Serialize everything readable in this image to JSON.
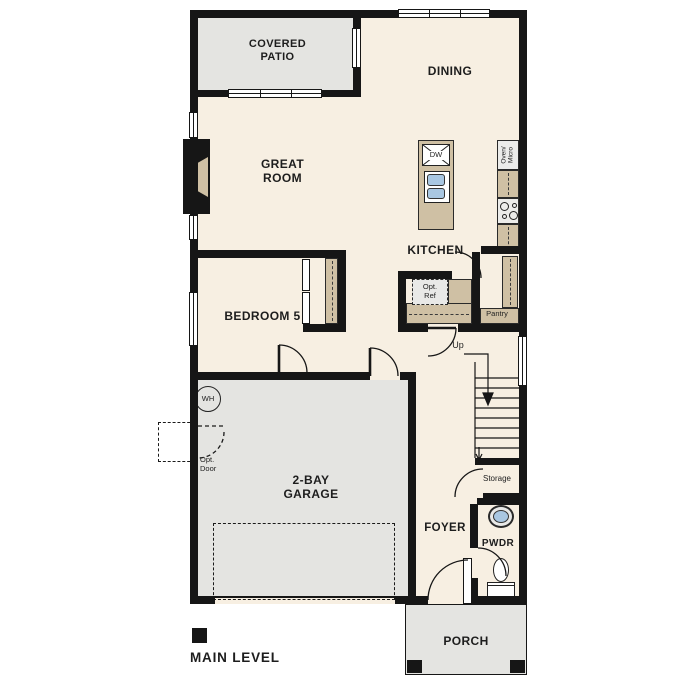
{
  "title": "MAIN LEVEL",
  "colors": {
    "wall": "#161616",
    "floor": "#f7efe2",
    "concrete": "#e4e4e1",
    "counter": "#cfc0a4",
    "fixture-blue": "#a9c7e2",
    "appliance": "#ececea",
    "text": "#1d1d1d",
    "paper": "#ffffff"
  },
  "rooms": {
    "covered_patio": "COVERED\nPATIO",
    "dining": "DINING",
    "great_room": "GREAT\nROOM",
    "kitchen": "KITCHEN",
    "bedroom5": "BEDROOM 5",
    "garage": "2-BAY\nGARAGE",
    "foyer": "FOYER",
    "pwdr": "PWDR",
    "porch": "PORCH"
  },
  "annotations": {
    "pantry": "Pantry",
    "storage": "Storage",
    "up": "Up",
    "opt_ref": "Opt.\nRef",
    "opt_door": "Opt.\nDoor",
    "oven_micro": "Oven/\nMicro",
    "dw": "DW",
    "wh": "WH"
  }
}
